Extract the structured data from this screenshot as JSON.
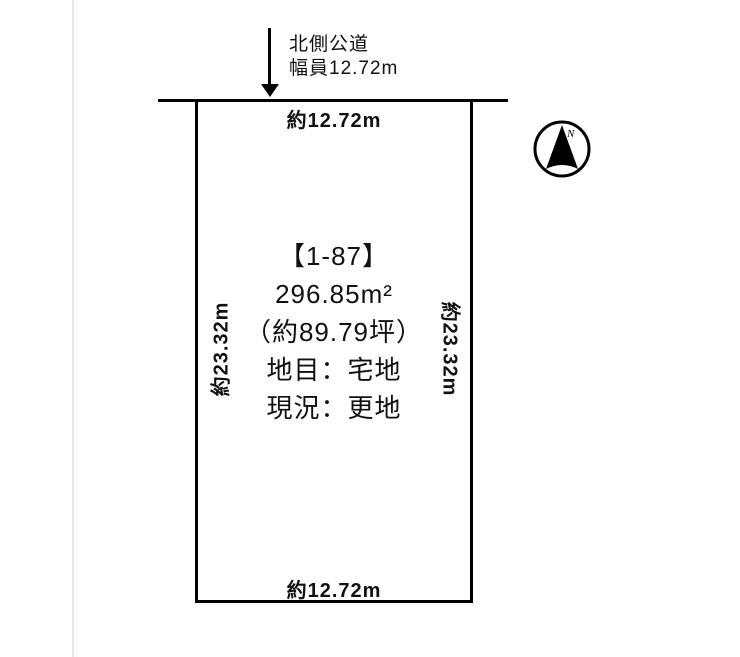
{
  "road": {
    "name": "北側公道",
    "width_label": "幅員12.72m"
  },
  "plot": {
    "top_label": "約12.72m",
    "bottom_label": "約12.72m",
    "left_label": "約23.32m",
    "right_label": "約23.32m",
    "lot_number": "【1-87】",
    "area_sqm": "296.85m²",
    "area_tsubo": "（約89.79坪）",
    "land_category": "地目：宅地",
    "current_status": "現況：更地"
  },
  "compass": {
    "north_label": "N"
  },
  "colors": {
    "line": "#000000",
    "background": "#ffffff",
    "frame_line": "#e6e6e6"
  }
}
